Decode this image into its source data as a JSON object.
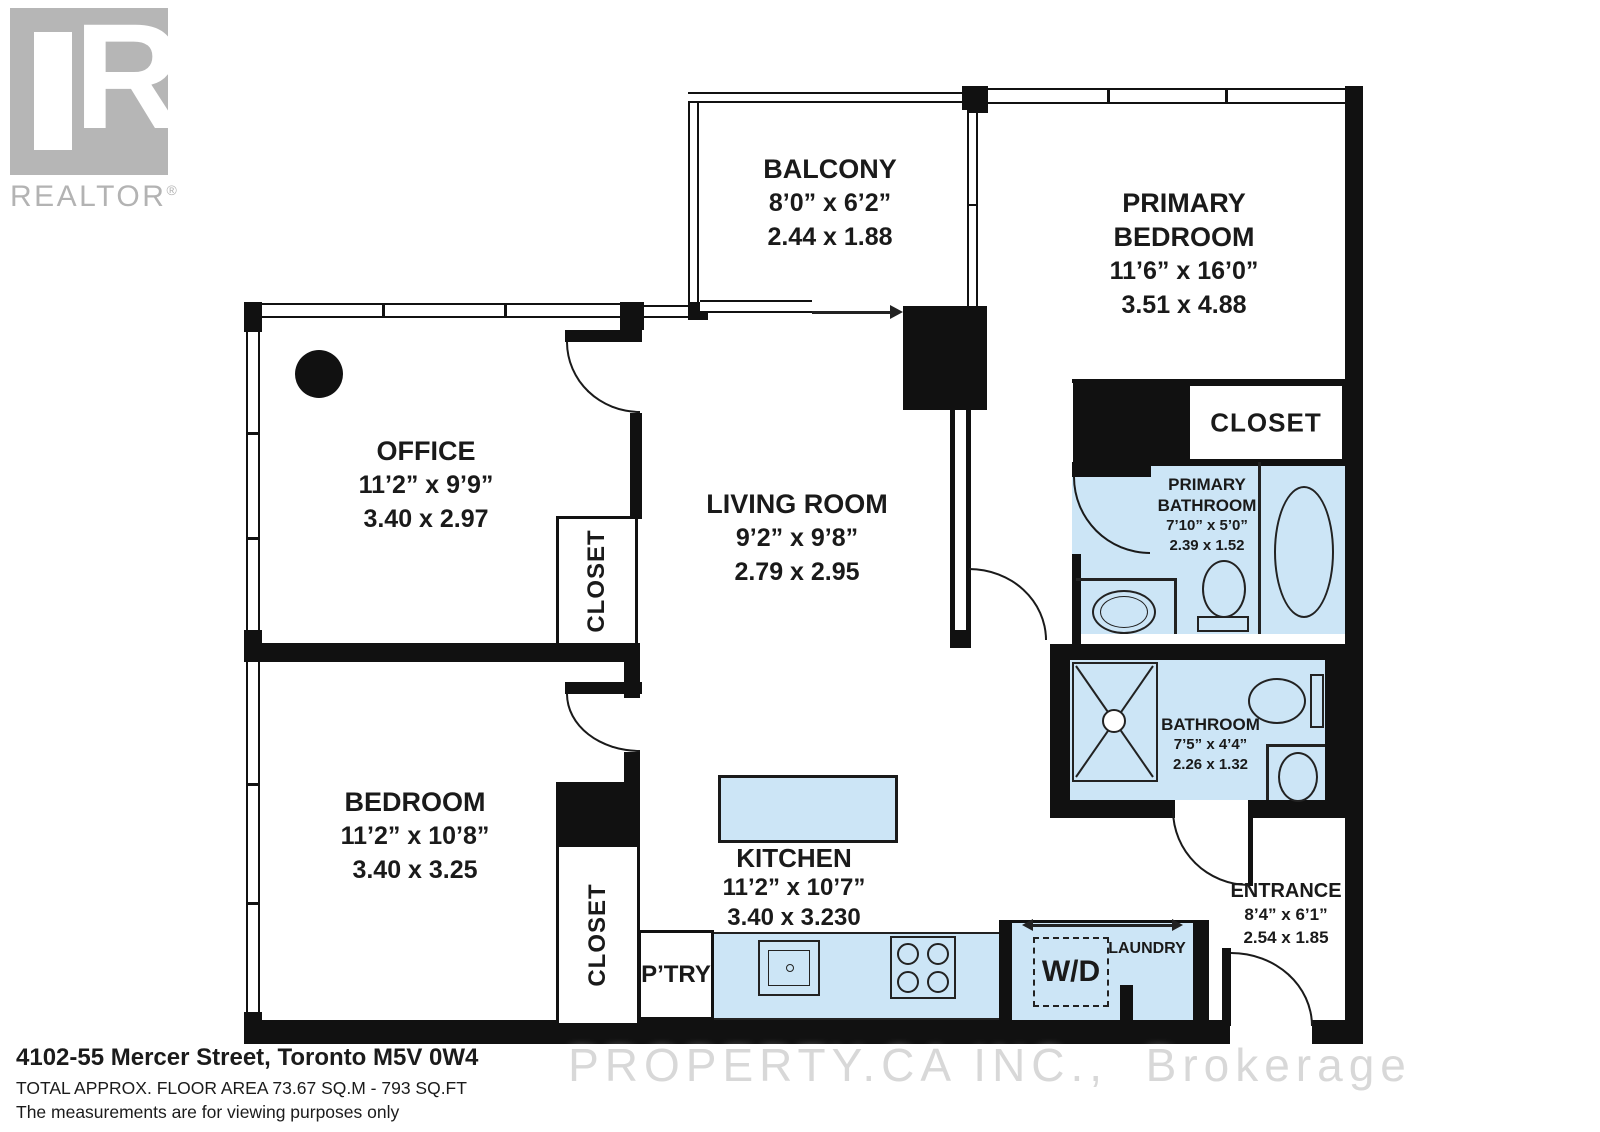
{
  "colors": {
    "wall": "#111111",
    "wet_area_fill": "#cce5f6",
    "watermark_gray": "#d8d8d8",
    "logo_gray": "#b6b6b6",
    "label_text": "#1a1a1a"
  },
  "branding": {
    "logo_letter": "R",
    "logo_text": "REALTOR",
    "registered": "®"
  },
  "watermark": {
    "text": "PROPERTY.CA INC.,  Brokerage"
  },
  "rooms": {
    "balcony": {
      "name": "BALCONY",
      "imperial": "8’0” x 6’2”",
      "metric": "2.44 x 1.88"
    },
    "office": {
      "name": "OFFICE",
      "imperial": "11’2” x 9’9”",
      "metric": "3.40 x 2.97"
    },
    "living_room": {
      "name": "LIVING ROOM",
      "imperial": "9’2” x 9’8”",
      "metric": "2.79 x 2.95"
    },
    "bedroom": {
      "name": "BEDROOM",
      "imperial": "11’2” x 10’8”",
      "metric": "3.40 x 3.25"
    },
    "kitchen": {
      "name": "KITCHEN",
      "imperial": "11’2” x 10’7”",
      "metric": "3.40 x 3.230"
    },
    "primary_bedroom": {
      "name_line1": "PRIMARY",
      "name_line2": "BEDROOM",
      "imperial": "11’6” x 16’0”",
      "metric": "3.51 x 4.88"
    },
    "primary_bathroom": {
      "name_line1": "PRIMARY",
      "name_line2": "BATHROOM",
      "imperial": "7’10” x 5’0”",
      "metric": "2.39 x 1.52"
    },
    "bathroom": {
      "name": "BATHROOM",
      "imperial": "7’5” x 4’4”",
      "metric": "2.26 x 1.32"
    },
    "entrance": {
      "name": "ENTRANCE",
      "imperial": "8’4” x 6’1”",
      "metric": "2.54 x 1.85"
    }
  },
  "labels": {
    "closet": "CLOSET",
    "pantry": "P’TRY",
    "washer_dryer": "W/D",
    "laundry": "LAUNDRY"
  },
  "footer": {
    "address": "4102-55 Mercer Street, Toronto M5V 0W4",
    "area": "TOTAL APPROX. FLOOR AREA 73.67 SQ.M - 793 SQ.FT",
    "disclaimer": "The measurements are for viewing purposes only"
  }
}
